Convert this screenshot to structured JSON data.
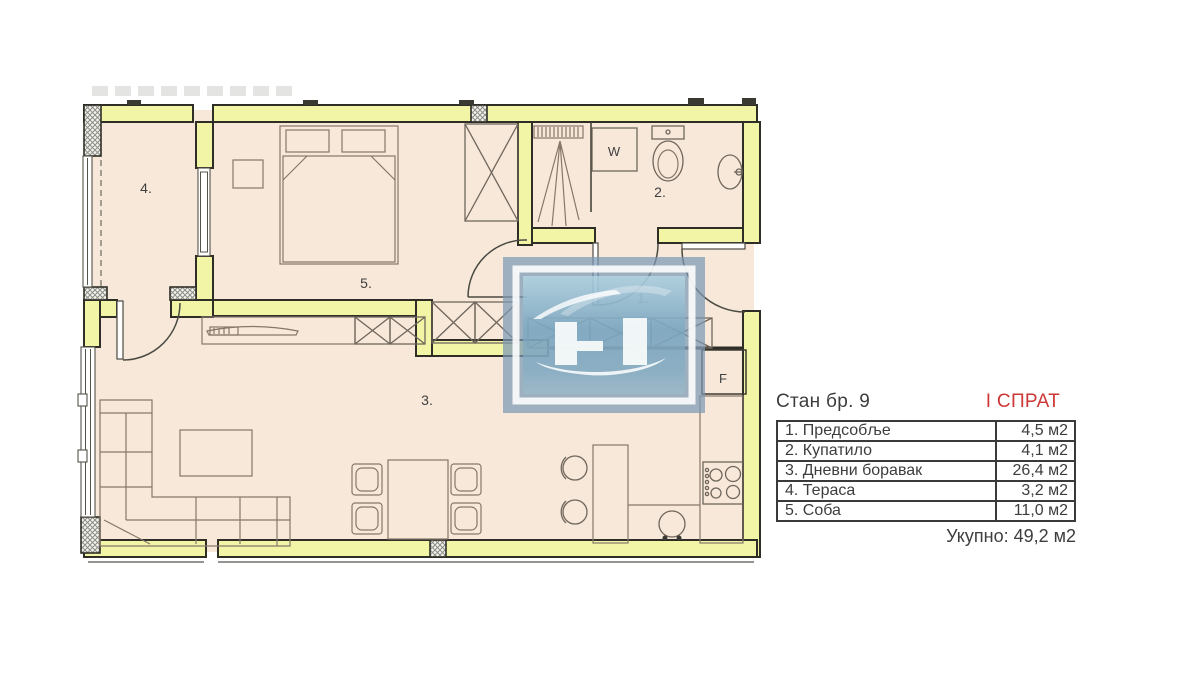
{
  "panel": {
    "title": "Стан бр. 9",
    "floor": "I СПРАТ",
    "rows": [
      {
        "name": "1. Предсобље",
        "area": "4,5 м2"
      },
      {
        "name": "2. Купатило",
        "area": "4,1 м2"
      },
      {
        "name": "3. Дневни боравак",
        "area": "26,4 м2"
      },
      {
        "name": "4. Тераса",
        "area": "3,2 м2"
      },
      {
        "name": "5. Соба",
        "area": "11,0 м2"
      }
    ],
    "total": "Укупно: 49,2 м2"
  },
  "plan": {
    "labels": {
      "hall": "1.",
      "bathroom": "2.",
      "living": "3.",
      "terrace": "4.",
      "bedroom": "5.",
      "washing_machine": "W",
      "shaft": "F"
    }
  },
  "colors": {
    "wall_fill": "#f2f5a6",
    "floor_fill": "#f8e8da",
    "outline": "#2e2e26",
    "accent_red": "#ce3737",
    "logo_blue": "#7b99b4"
  }
}
